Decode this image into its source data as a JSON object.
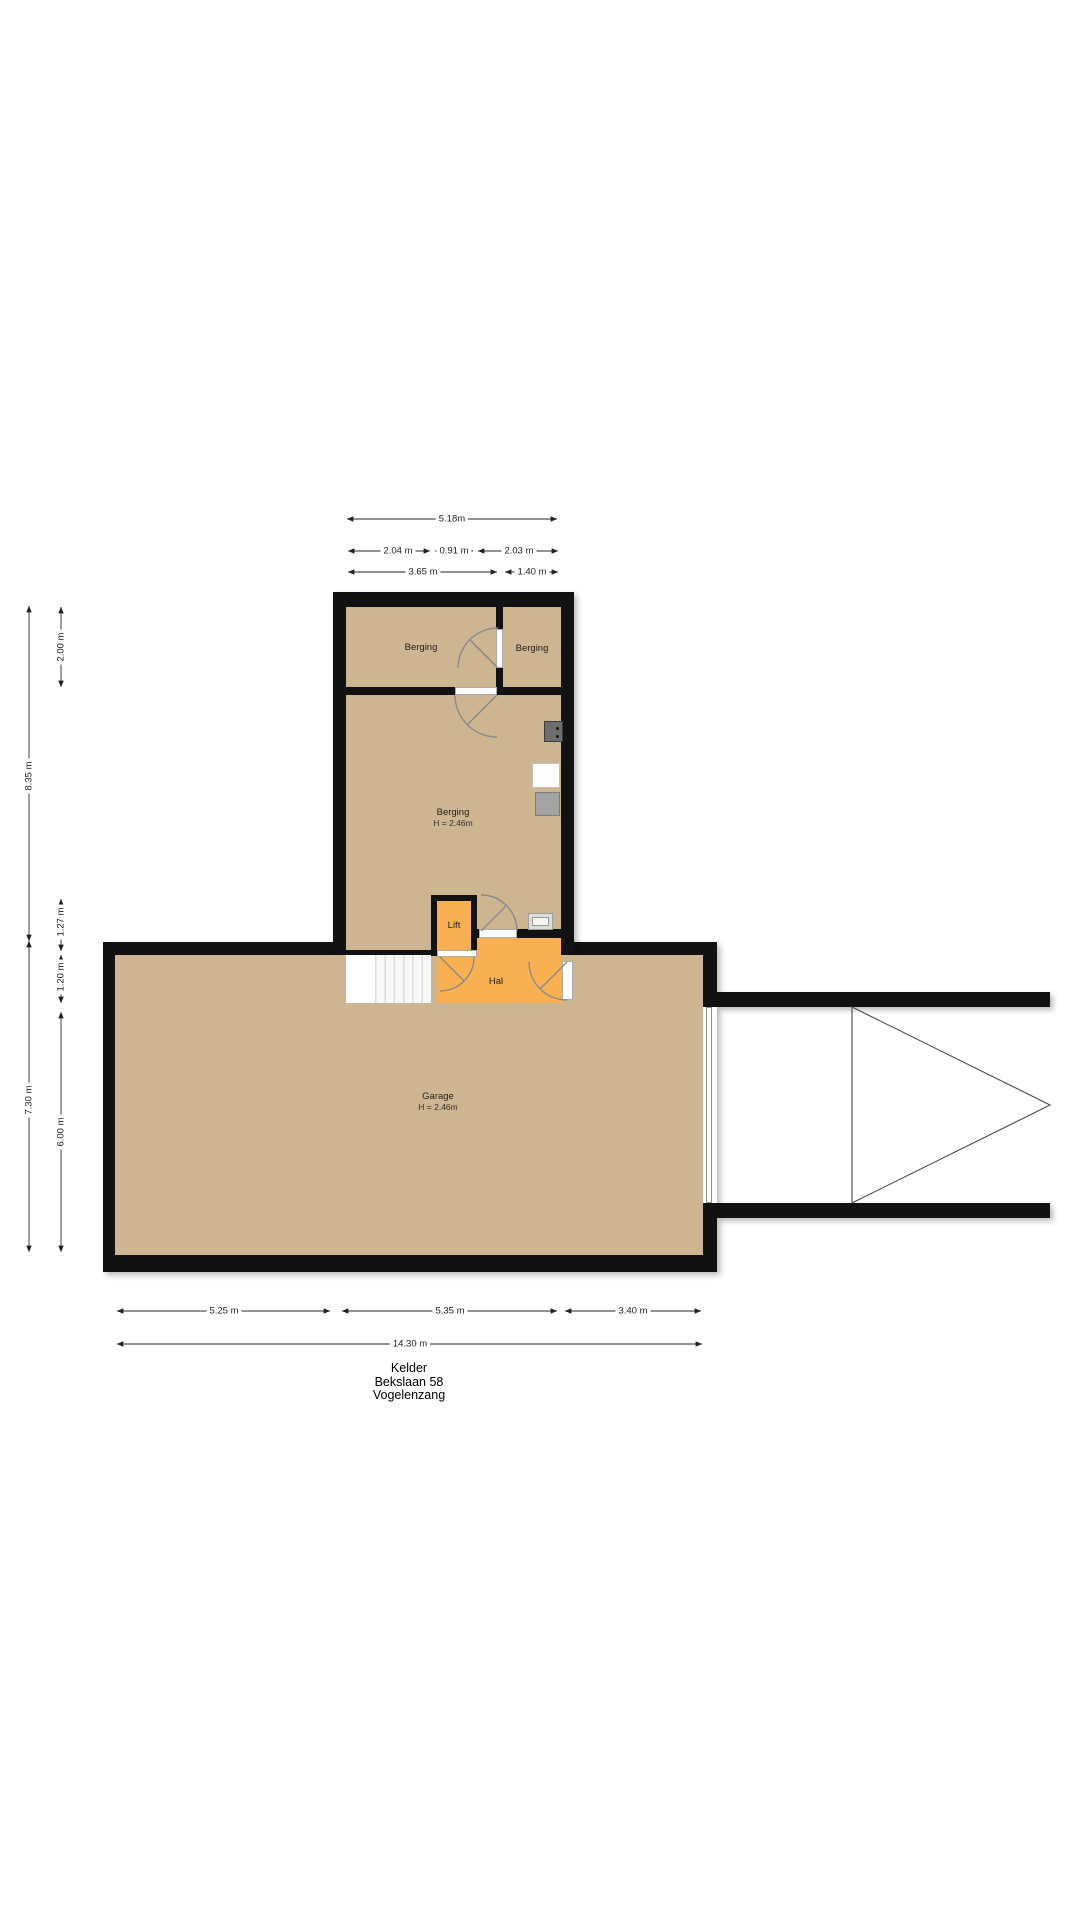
{
  "plan_title": {
    "line1": "Kelder",
    "line2": "Bekslaan 58",
    "line3": "Vogelenzang"
  },
  "rooms": {
    "berging_top_left": {
      "label": "Berging"
    },
    "berging_top_right": {
      "label": "Berging"
    },
    "berging_main": {
      "label": "Berging",
      "height": "H = 2.46m"
    },
    "lift": {
      "label": "Lift"
    },
    "hal": {
      "label": "Hal"
    },
    "garage": {
      "label": "Garage",
      "height": "H = 2.46m"
    }
  },
  "dimensions": {
    "top": {
      "total": "5.18m",
      "seg_a": "2.04 m",
      "seg_b": "0.91 m",
      "seg_c": "2.03 m",
      "seg_d": "3.65 m",
      "seg_e": "1.40 m"
    },
    "left": {
      "berging_top": "2.00 m",
      "tower": "8.35 m",
      "lift": "1.27 m",
      "stairs": "1.20 m",
      "garage_outer": "7.30 m",
      "garage_inner": "6.00 m"
    },
    "bottom": {
      "seg_a": "5.25 m",
      "seg_b": "5.35 m",
      "seg_c": "3.40 m",
      "total": "14.30 m"
    }
  },
  "colors": {
    "paper": "#ffffff",
    "wall": "#121212",
    "floor_tan": "#cdb592",
    "floor_orange": "#f8b052",
    "dim_text": "#1d1d1d"
  }
}
